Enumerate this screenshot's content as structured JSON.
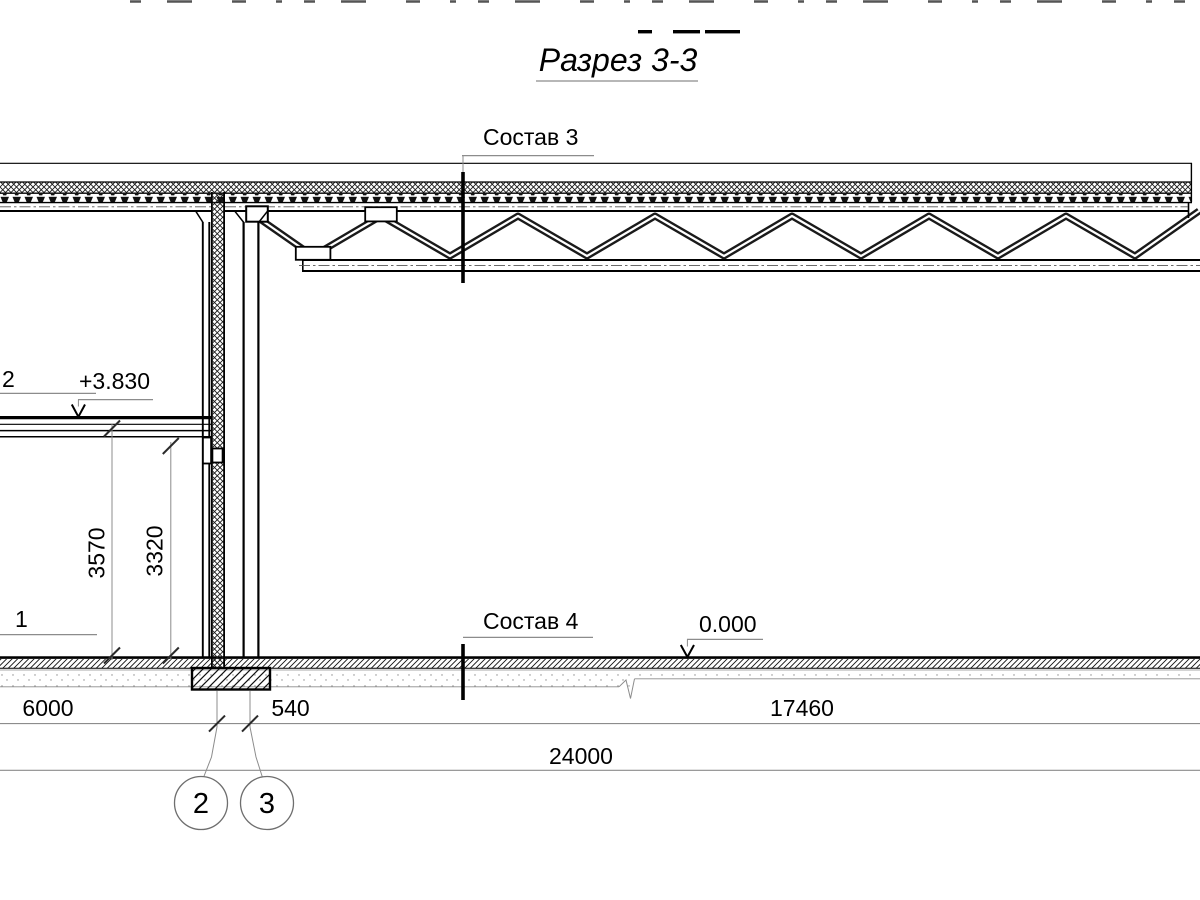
{
  "drawing": {
    "title": "Разрез 3-3",
    "cut_marks": {
      "roof": "Состав 3",
      "floor": "Состав 4"
    },
    "partial_labels": {
      "upper": "2",
      "lower": "1"
    },
    "elevations": {
      "second_floor": "+3.830",
      "ground_floor": "0.000"
    },
    "dimensions": {
      "story_height_outer": "3570",
      "story_height_inner": "3320",
      "bay_left": "6000",
      "wall_offset": "540",
      "bay_right": "17460",
      "total_span": "24000"
    },
    "grid_axes": [
      {
        "label": "2"
      },
      {
        "label": "3"
      }
    ],
    "line_colors": {
      "main": "#000000",
      "aux": "#8c8c8c"
    }
  }
}
